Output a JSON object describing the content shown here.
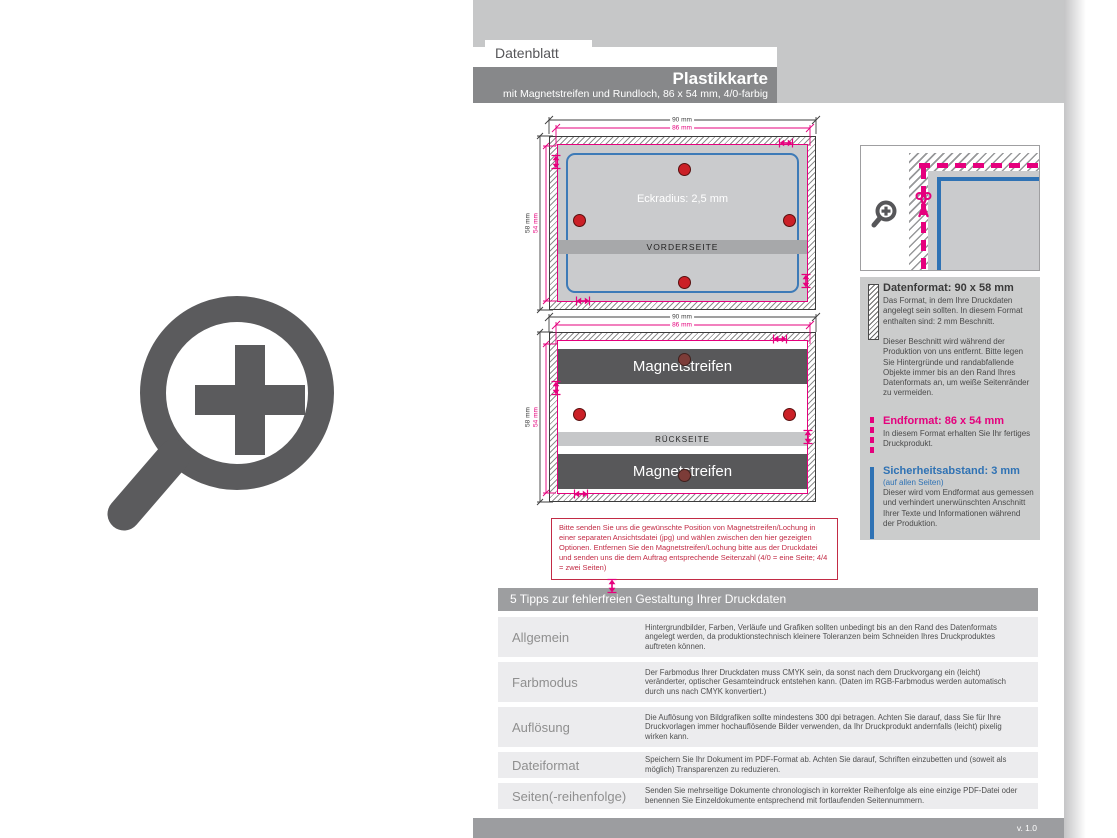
{
  "header": {
    "tab": "Datenblatt",
    "title": "Plastikkarte",
    "subtitle": "mit Magnetstreifen und Rundloch, 86 x 54 mm, 4/0-farbig"
  },
  "diagram": {
    "dims": {
      "outer_width": "90 mm",
      "inner_width": "86 mm",
      "outer_height": "58 mm",
      "inner_height": "54 mm"
    },
    "front": {
      "radius_label": "Eckradius: 2,5 mm",
      "side_label": "VORDERSEITE"
    },
    "back": {
      "stripe_label": "Magnetstreifen",
      "side_label": "RÜCKSEITE"
    },
    "note": "Bitte senden Sie uns die gewünschte Position von Magnetstreifen/Lochung in einer separaten Ansichtsdatei (jpg) und wählen zwischen den hier gezeigten Optionen. Entfernen Sie den Magnetstreifen/Lochung bitte aus der Druckdatei und senden uns die dem Auftrag entsprechende Seitenzahl (4/0 = eine Seite; 4/4 = zwei Seiten)"
  },
  "info": {
    "datenformat": {
      "title": "Datenformat: 90 x 58 mm",
      "body": "Das Format, in dem Ihre Druckdaten angelegt sein sollten. In diesem Format enthalten sind: 2 mm Beschnitt.",
      "body2": "Dieser Beschnitt wird während der Produktion von uns entfernt. Bitte legen Sie Hintergründe und rand­abfallende Objekte immer bis an den Rand Ihres Datenformats an, um weiße Seitenränder zu vermeiden."
    },
    "endformat": {
      "title": "Endformat: 86 x 54 mm",
      "body": "In diesem Format erhalten Sie Ihr fertiges Druckprodukt."
    },
    "safety": {
      "title": "Sicherheitsabstand: 3 mm",
      "subtitle": "(auf allen Seiten)",
      "body": "Dieser wird vom Endformat aus gemessen und verhindert unerwünschten Anschnitt Ihrer Texte und Informationen während der Produktion."
    }
  },
  "tips": {
    "title": "5 Tipps zur fehlerfreien Gestaltung Ihrer Druckdaten",
    "rows": [
      {
        "label": "Allgemein",
        "text": "Hintergrundbilder, Farben, Verläufe und Grafiken sollten unbedingt bis an den Rand des Datenformats angelegt werden, da produktionstechnisch kleinere Toleranzen beim Schneiden Ihres Druckproduktes auftreten können."
      },
      {
        "label": "Farbmodus",
        "text": "Der Farbmodus Ihrer Druckdaten muss CMYK sein, da sonst nach dem Druckvorgang ein (leicht) veränderter, optischer Gesamteindruck entstehen kann. (Daten im RGB-Farbmodus werden automatisch durch uns nach CMYK konvertiert.)"
      },
      {
        "label": "Auflösung",
        "text": "Die Auflösung von Bildgrafiken sollte mindestens 300 dpi betragen. Achten Sie darauf, dass Sie für Ihre Druckvorlagen immer hochauflösende Bilder verwenden, da Ihr Druckprodukt andernfalls (leicht) pixelig wirken kann."
      },
      {
        "label": "Dateiformat",
        "text": "Speichern Sie Ihr Dokument im PDF-Format ab. Achten Sie darauf, Schriften einzubetten und (soweit als möglich) Transparenzen zu reduzieren."
      },
      {
        "label": "Seiten(-reihenfolge)",
        "text": "Senden Sie mehrseitige Dokumente chronologisch in korrekter Reihenfolge als eine einzige PDF-Datei oder benennen Sie Einzeldokumente entsprechend mit fortlaufenden Seitennummern."
      }
    ]
  },
  "footer": {
    "version": "v. 1.0"
  },
  "icons": {
    "left_large": "zoom-plus-icon",
    "corner_detail": "zoom-plus-icon",
    "cut_line": "scissors-icon"
  },
  "colors": {
    "accent_magenta": "#e5007d",
    "accent_blue": "#2f72b4",
    "hole_red": "#cb2027",
    "header_dark": "#87888a",
    "band_gray": "#c6c7c8"
  }
}
